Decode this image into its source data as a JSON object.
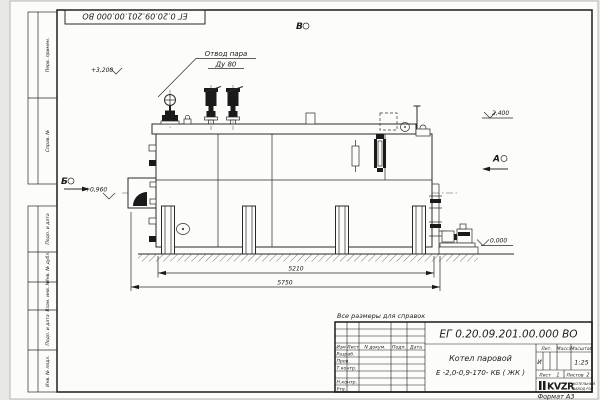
{
  "page": {
    "corner_stamp": "ЕГ 0.20.09.201.00.000 ВО",
    "reference_note": "Все размеры для справок",
    "format_note": "Формат А3"
  },
  "margin": {
    "labels": [
      "Перв. примен.",
      "Справ. №",
      "Подп. и дата",
      "Инв. № дубл.",
      "Взам. инв. №",
      "Подп. и дата",
      "Инв. № подл."
    ]
  },
  "drawing": {
    "callout": {
      "line1": "Отвод пара",
      "line2": "Ду 80"
    },
    "elevations": {
      "valve_top": "+3,200",
      "deck": "2,400",
      "burner_axis": "+0,960",
      "ground": "0,000"
    },
    "views": {
      "top": "В",
      "right": "А",
      "left": "Б"
    },
    "dimensions": {
      "base": "5210",
      "overall": "5750"
    }
  },
  "title_block": {
    "designation": "ЕГ 0.20.09.201.00.000 ВО",
    "product_line1": "Котел паровой",
    "product_line2": "Е -2,0-0,9-170- КБ ( ЖК )",
    "columns": {
      "izm": "Изм",
      "list": "Лист",
      "doc": "N докум.",
      "podp": "Подп.",
      "data": "Дата"
    },
    "rows": {
      "r1": "Разраб.",
      "r2": "Пров.",
      "r3": "Т.контр.",
      "r4": "Н.контр.",
      "r5": "Утв."
    },
    "lit_label": "Лит.",
    "lit_value": "И",
    "mass_label": "Масса",
    "scale_label": "Масштаб",
    "scale_value": "1:25",
    "sheet_label": "Лист",
    "sheet_value": "1",
    "sheets_label": "Листов",
    "sheets_value": "2",
    "logo_text": "KVZR",
    "logo_sub1": "КОТЕЛЬНЫЙ",
    "logo_sub2": "ЗАВОД РЭП"
  }
}
